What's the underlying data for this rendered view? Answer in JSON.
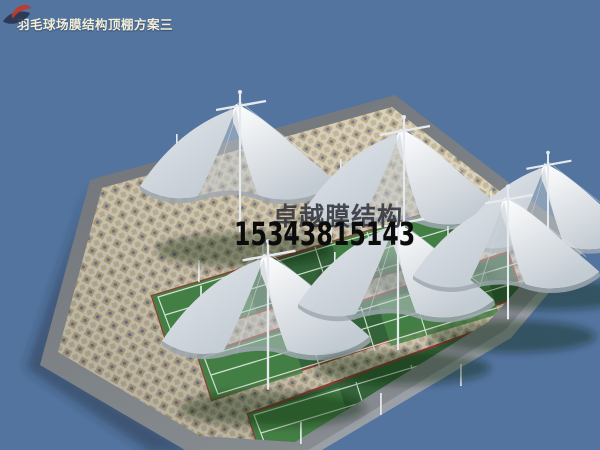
{
  "meta": {
    "title_label": "羽毛球场膜结构顶棚方案三"
  },
  "watermark": {
    "company": "卓越膜结构",
    "phone": "15343815143",
    "logo": "swoosh-bird-logo"
  },
  "scene": {
    "description": "3D architectural render: badminton courts with white tensile membrane canopy roofs on a mosaic-paved platform",
    "court_count": 3,
    "canopy_count": 6,
    "objects": [
      "sky",
      "cast-shadow",
      "platform-apron",
      "mosaic-plaza",
      "badminton-courts",
      "membrane-canopies",
      "masts",
      "fence-posts"
    ]
  },
  "colors": {
    "sky": "#52749e",
    "ground-shadow": "rgba(30,42,64,0.45)",
    "apron-dark": "#6f7377",
    "apron-light": "#888d92",
    "side-face": "#9aa0a6",
    "mosaic-base": "#d8cfb6",
    "mosaic-tan": "#b59a6b",
    "mosaic-blue": "#5e7292",
    "mosaic-dark": "#c0b391",
    "court-green": "#336439",
    "court-green-light": "#478447",
    "court-line": "#e9f1e9",
    "court-border": "#8a4035",
    "membrane-white": "#ffffff",
    "membrane-mid": "#e3e8ed",
    "membrane-shade": "#c2cad2",
    "membrane-dark": "#9fa8b1",
    "mast": "#e6eaee",
    "canopy-shadow": "rgba(10,22,12,0.38)",
    "title-color": "#f2eeda",
    "watermark-text": "#33343c",
    "watermark-phone": "#0c0c0c",
    "logo-red": "#c0392c",
    "logo-navy": "#2a3550"
  }
}
